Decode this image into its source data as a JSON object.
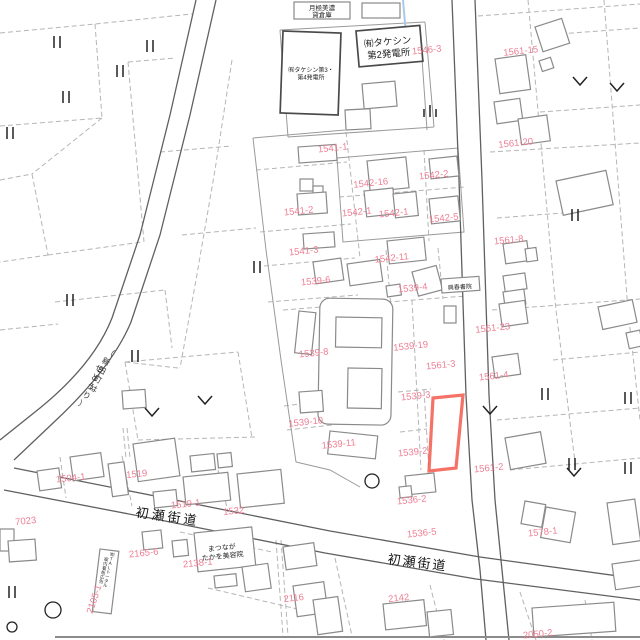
{
  "map": {
    "colors": {
      "parcel_number": "#ee7e93",
      "highlight": "#f2594b",
      "line": "#9a9a9a",
      "dashed": "#b5b5b5",
      "road": "#606060",
      "text": "#1f1f1f",
      "water_line": "#a9c9e6"
    },
    "road_labels": [
      {
        "text": "初瀬街道",
        "x": 167,
        "y": 521,
        "rot": 8,
        "size": 13,
        "ls": 3
      },
      {
        "text": "初瀬街道",
        "x": 417,
        "y": 567,
        "rot": 7,
        "size": 13,
        "ls": 2
      }
    ],
    "place_labels": [
      {
        "lines": [
          "月極美濃",
          "貸倉庫"
        ],
        "x": 322,
        "y": 10,
        "size": 6.5,
        "lh": 7,
        "rot": 0
      },
      {
        "lines": [
          "㈲タケシン",
          "第2発電所"
        ],
        "x": 388,
        "y": 45,
        "size": 9.5,
        "lh": 12,
        "rot": -5
      },
      {
        "lines": [
          "㈲タケシン第3・",
          "第4発電所"
        ],
        "x": 311,
        "y": 72,
        "size": 6,
        "lh": 7.5,
        "rot": 0
      },
      {
        "lines": [
          "興春書院"
        ],
        "x": 460,
        "y": 289,
        "size": 6,
        "lh": 7,
        "rot": -4
      },
      {
        "lines": [
          "まつなが",
          "たかを美容院"
        ],
        "x": 222,
        "y": 550,
        "size": 7,
        "lh": 8.5,
        "rot": -6
      }
    ],
    "vertical_labels": [
      {
        "text": "（新田町は",
        "x": 109,
        "y": 355,
        "dx": -4.2,
        "dy": 9,
        "rot": 27,
        "size": 8
      },
      {
        "text": "せどうり）",
        "x": 98,
        "y": 371,
        "dx": -4.2,
        "dy": 9,
        "rot": 27,
        "size": 8
      },
      {
        "text": "㈲TALトータル",
        "x": 112,
        "y": 556,
        "dx": -1,
        "dy": 4.4,
        "rot": 10,
        "size": 4.5
      },
      {
        "text": "案内看板広告",
        "x": 106,
        "y": 561,
        "dx": -1,
        "dy": 4.4,
        "rot": 10,
        "size": 4.5
      }
    ],
    "parcel_numbers": [
      {
        "t": "1546-3",
        "x": 427,
        "y": 53
      },
      {
        "t": "1561-15",
        "x": 521,
        "y": 54
      },
      {
        "t": "1561-20",
        "x": 516,
        "y": 146
      },
      {
        "t": "1541-1",
        "x": 333,
        "y": 151
      },
      {
        "t": "1542-16",
        "x": 371,
        "y": 186
      },
      {
        "t": "1542-2",
        "x": 434,
        "y": 178
      },
      {
        "t": "1541-2",
        "x": 299,
        "y": 214
      },
      {
        "t": "1542-1",
        "x": 357,
        "y": 215
      },
      {
        "t": "1542-1",
        "x": 394,
        "y": 216
      },
      {
        "t": "1542-5",
        "x": 444,
        "y": 221
      },
      {
        "t": "1541-3",
        "x": 304,
        "y": 254
      },
      {
        "t": "1542-11",
        "x": 392,
        "y": 261
      },
      {
        "t": "1539-6",
        "x": 316,
        "y": 284
      },
      {
        "t": "1539-4",
        "x": 413,
        "y": 291
      },
      {
        "t": "1539-19",
        "x": 411,
        "y": 349
      },
      {
        "t": "1539-8",
        "x": 314,
        "y": 356
      },
      {
        "t": "1561-8",
        "x": 509,
        "y": 243
      },
      {
        "t": "1561-23",
        "x": 493,
        "y": 331
      },
      {
        "t": "1561-3",
        "x": 441,
        "y": 368
      },
      {
        "t": "1561-4",
        "x": 494,
        "y": 379
      },
      {
        "t": "1539-3",
        "x": 416,
        "y": 399
      },
      {
        "t": "1539-10",
        "x": 306,
        "y": 425
      },
      {
        "t": "1539-11",
        "x": 339,
        "y": 447
      },
      {
        "t": "1539-2",
        "x": 413,
        "y": 455
      },
      {
        "t": "1561-2",
        "x": 489,
        "y": 471
      },
      {
        "t": "1536-2",
        "x": 412,
        "y": 503
      },
      {
        "t": "1536-5",
        "x": 422,
        "y": 536
      },
      {
        "t": "1578-1",
        "x": 543,
        "y": 535
      },
      {
        "t": "1504-1",
        "x": 71,
        "y": 481
      },
      {
        "t": "1519",
        "x": 137,
        "y": 477
      },
      {
        "t": "1519-1",
        "x": 186,
        "y": 507
      },
      {
        "t": "1532",
        "x": 234,
        "y": 514
      },
      {
        "t": "7023",
        "x": 26,
        "y": 524
      },
      {
        "t": "2165-6",
        "x": 144,
        "y": 556
      },
      {
        "t": "2138-1",
        "x": 198,
        "y": 566
      },
      {
        "t": "2116",
        "x": 294,
        "y": 601
      },
      {
        "t": "2142",
        "x": 399,
        "y": 601
      },
      {
        "t": "2050-2",
        "x": 538,
        "y": 637
      },
      {
        "t": "2105-1",
        "x": 97,
        "y": 600,
        "r": -72
      }
    ],
    "symbols": {
      "paddy": [
        [
          57,
          42
        ],
        [
          150,
          46
        ],
        [
          120,
          71
        ],
        [
          66,
          97
        ],
        [
          10,
          133
        ],
        [
          70,
          300
        ],
        [
          257,
          267
        ],
        [
          135,
          356
        ],
        [
          575,
          215
        ],
        [
          545,
          394
        ],
        [
          572,
          464
        ],
        [
          628,
          398
        ],
        [
          628,
          468
        ],
        [
          12,
          592
        ]
      ],
      "paddy3": [
        [
          430,
          112
        ]
      ],
      "field": [
        [
          580,
          81
        ],
        [
          617,
          87
        ],
        [
          152,
          412
        ],
        [
          205,
          400
        ],
        [
          490,
          410
        ],
        [
          574,
          472
        ]
      ],
      "circles": [
        [
          372,
          481,
          7
        ],
        [
          53,
          610,
          8
        ],
        [
          12,
          627,
          5
        ]
      ]
    }
  }
}
